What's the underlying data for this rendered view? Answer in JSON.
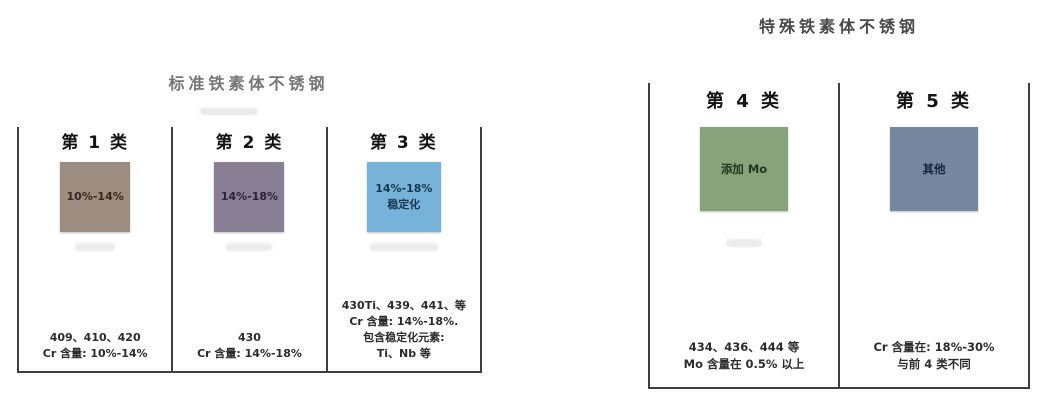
{
  "page": {
    "background": "#ffffff",
    "line_color": "#3f3f3f"
  },
  "groups": [
    {
      "title": "标准铁素体不锈钢",
      "classes": [
        {
          "header": "第 1 类",
          "box": {
            "label_lines": [
              "10%-14%"
            ],
            "color": "#9d8d80"
          },
          "notes": [
            "409、410、420",
            "Cr 含量: 10%-14%"
          ]
        },
        {
          "header": "第 2 类",
          "box": {
            "label_lines": [
              "14%-18%"
            ],
            "color": "#897f94"
          },
          "notes": [
            "430",
            "Cr 含量: 14%-18%"
          ]
        },
        {
          "header": "第 3 类",
          "box": {
            "label_lines": [
              "14%-18%",
              "稳定化"
            ],
            "color": "#77b3d8"
          },
          "notes": [
            "430Ti、439、441、等",
            "Cr 含量: 14%-18%.",
            "包含稳定化元素:",
            "Ti、Nb 等"
          ]
        }
      ]
    },
    {
      "title": "特殊铁素体不锈钢",
      "classes": [
        {
          "header": "第 4 类",
          "box": {
            "label_lines": [
              "添加 Mo"
            ],
            "color": "#88a37b"
          },
          "notes": [
            "434、436、444 等",
            "Mo 含量在 0.5% 以上"
          ]
        },
        {
          "header": "第 5 类",
          "box": {
            "label_lines": [
              "其他"
            ],
            "color": "#76869f"
          },
          "notes": [
            "Cr 含量在: 18%-30%",
            "与前 4 类不同"
          ]
        }
      ]
    }
  ]
}
